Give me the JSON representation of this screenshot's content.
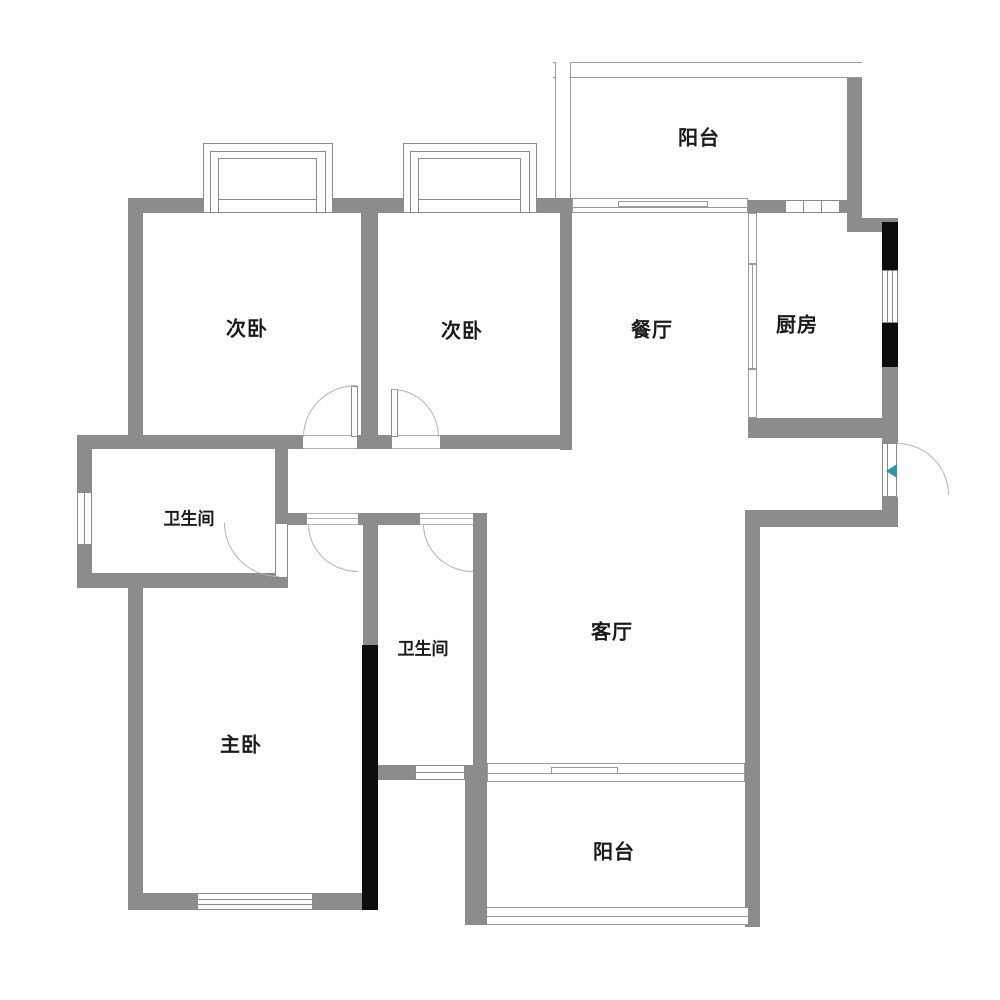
{
  "plan": {
    "type": "apartment-floor-plan",
    "rooms": {
      "balcony_top": {
        "label": "阳台"
      },
      "bedroom1": {
        "label": "次卧"
      },
      "bedroom2": {
        "label": "次卧"
      },
      "dining": {
        "label": "餐厅"
      },
      "kitchen": {
        "label": "厨房"
      },
      "bathroom1": {
        "label": "卫生间"
      },
      "bathroom2": {
        "label": "卫生间"
      },
      "master_bedroom": {
        "label": "主卧"
      },
      "living": {
        "label": "客厅"
      },
      "balcony_bottom": {
        "label": "阳台"
      }
    },
    "colors": {
      "wall_gray": "#8c8c8c",
      "structural_black": "#0d0d0d",
      "thin_line": "#9b9b9b",
      "door_arc": "#b3b3b3",
      "label_text": "#1a1a1a",
      "entry_arrow_teal": "#2e93a6",
      "background": "#ffffff"
    }
  }
}
